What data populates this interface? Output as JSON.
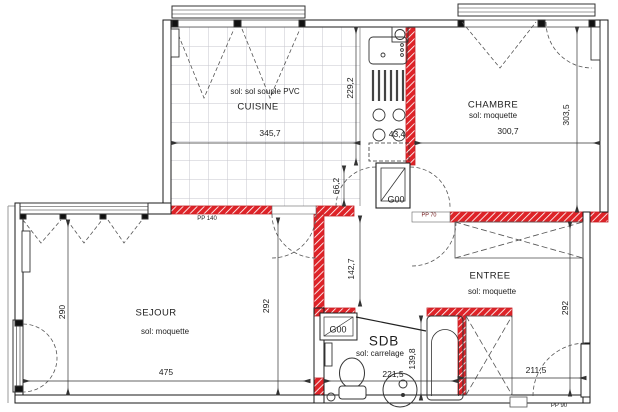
{
  "plan": {
    "rooms": {
      "cuisine": {
        "name": "CUISINE",
        "floor": "sol: sol souple PVC",
        "dim_width": "345,7",
        "dim_depth": "229,2"
      },
      "chambre": {
        "name": "CHAMBRE",
        "floor": "sol: moquette",
        "dim_width": "300,7",
        "dim_depth": "303,5"
      },
      "sejour": {
        "name": "SEJOUR",
        "floor": "sol: moquette",
        "dim_width": "475",
        "dim_depth_left": "290",
        "dim_depth_right": "292"
      },
      "entree": {
        "name": "ENTREE",
        "floor": "sol: moquette",
        "dim_width": "211,5",
        "dim_depth": "292",
        "dim_corridor": "142,7"
      },
      "sdb": {
        "name": "SDB",
        "floor": "sol: carrelage",
        "dim_width": "221,5",
        "dim_depth": "139,8"
      }
    },
    "dims": {
      "kitchen_unit": "43,4",
      "kitchen_door_gap": "66,2"
    },
    "doors": {
      "g00_kitchen": "G00",
      "g00_sdb": "G00",
      "pp140": "PP 140",
      "pp90": "PP 90",
      "pp70": "PP 70"
    },
    "colors": {
      "bearing_wall_red": "#de2328",
      "wall_black": "#1a1a1a",
      "tile_grid": "#c6c6cc"
    }
  }
}
